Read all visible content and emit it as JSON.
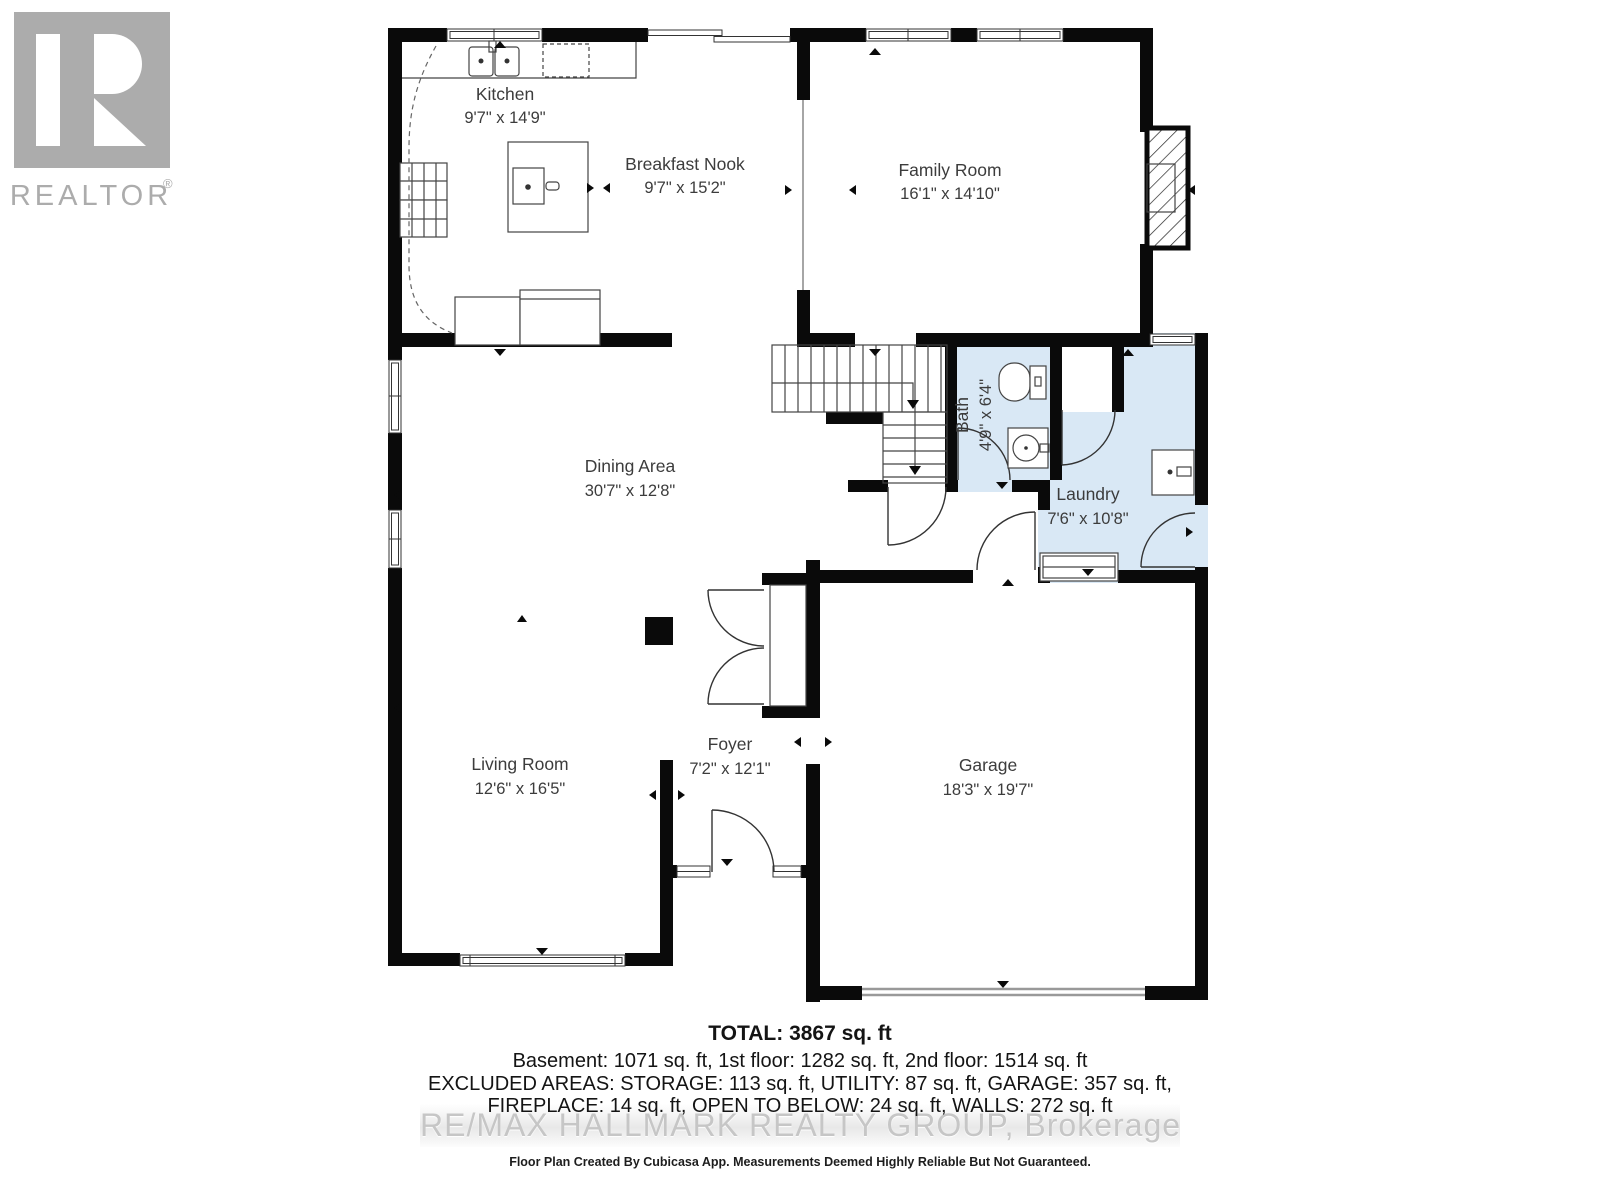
{
  "logo": {
    "name": "REALTOR",
    "reg": "®"
  },
  "rooms": [
    {
      "id": "kitchen",
      "name": "Kitchen",
      "dims": "9'7\" x 14'9\""
    },
    {
      "id": "breakfast-nook",
      "name": "Breakfast Nook",
      "dims": "9'7\" x 15'2\""
    },
    {
      "id": "family-room",
      "name": "Family Room",
      "dims": "16'1\" x 14'10\""
    },
    {
      "id": "dining-area",
      "name": "Dining Area",
      "dims": "30'7\" x 12'8\""
    },
    {
      "id": "bath",
      "name": "Bath",
      "dims": "4'9\" x 6'4\""
    },
    {
      "id": "laundry",
      "name": "Laundry",
      "dims": "7'6\" x 10'8\""
    },
    {
      "id": "living-room",
      "name": "Living Room",
      "dims": "12'6\" x 16'5\""
    },
    {
      "id": "foyer",
      "name": "Foyer",
      "dims": "7'2\" x 12'1\""
    },
    {
      "id": "garage",
      "name": "Garage",
      "dims": "18'3\" x 19'7\""
    }
  ],
  "summary": {
    "total": "TOTAL: 3867 sq. ft",
    "floors": "Basement: 1071 sq. ft, 1st floor: 1282 sq. ft, 2nd floor: 1514 sq. ft",
    "excluded1": "EXCLUDED AREAS: STORAGE: 113 sq. ft, UTILITY: 87 sq. ft, GARAGE: 357 sq. ft,",
    "excluded2": "FIREPLACE: 14 sq. ft, OPEN TO BELOW: 24 sq. ft, WALLS: 272 sq. ft"
  },
  "watermark": "RE/MAX HALLMARK REALTY GROUP, Brokerage",
  "disclaimer": "Floor Plan Created By Cubicasa App. Measurements Deemed Highly Reliable But Not Guaranteed.",
  "colors": {
    "wall": "#0a0a0a",
    "wet_room_fill": "#d9e8f5",
    "label": "#3c3c3c",
    "logo_gray": "#acacac",
    "watermark": "#c6c6c6"
  }
}
